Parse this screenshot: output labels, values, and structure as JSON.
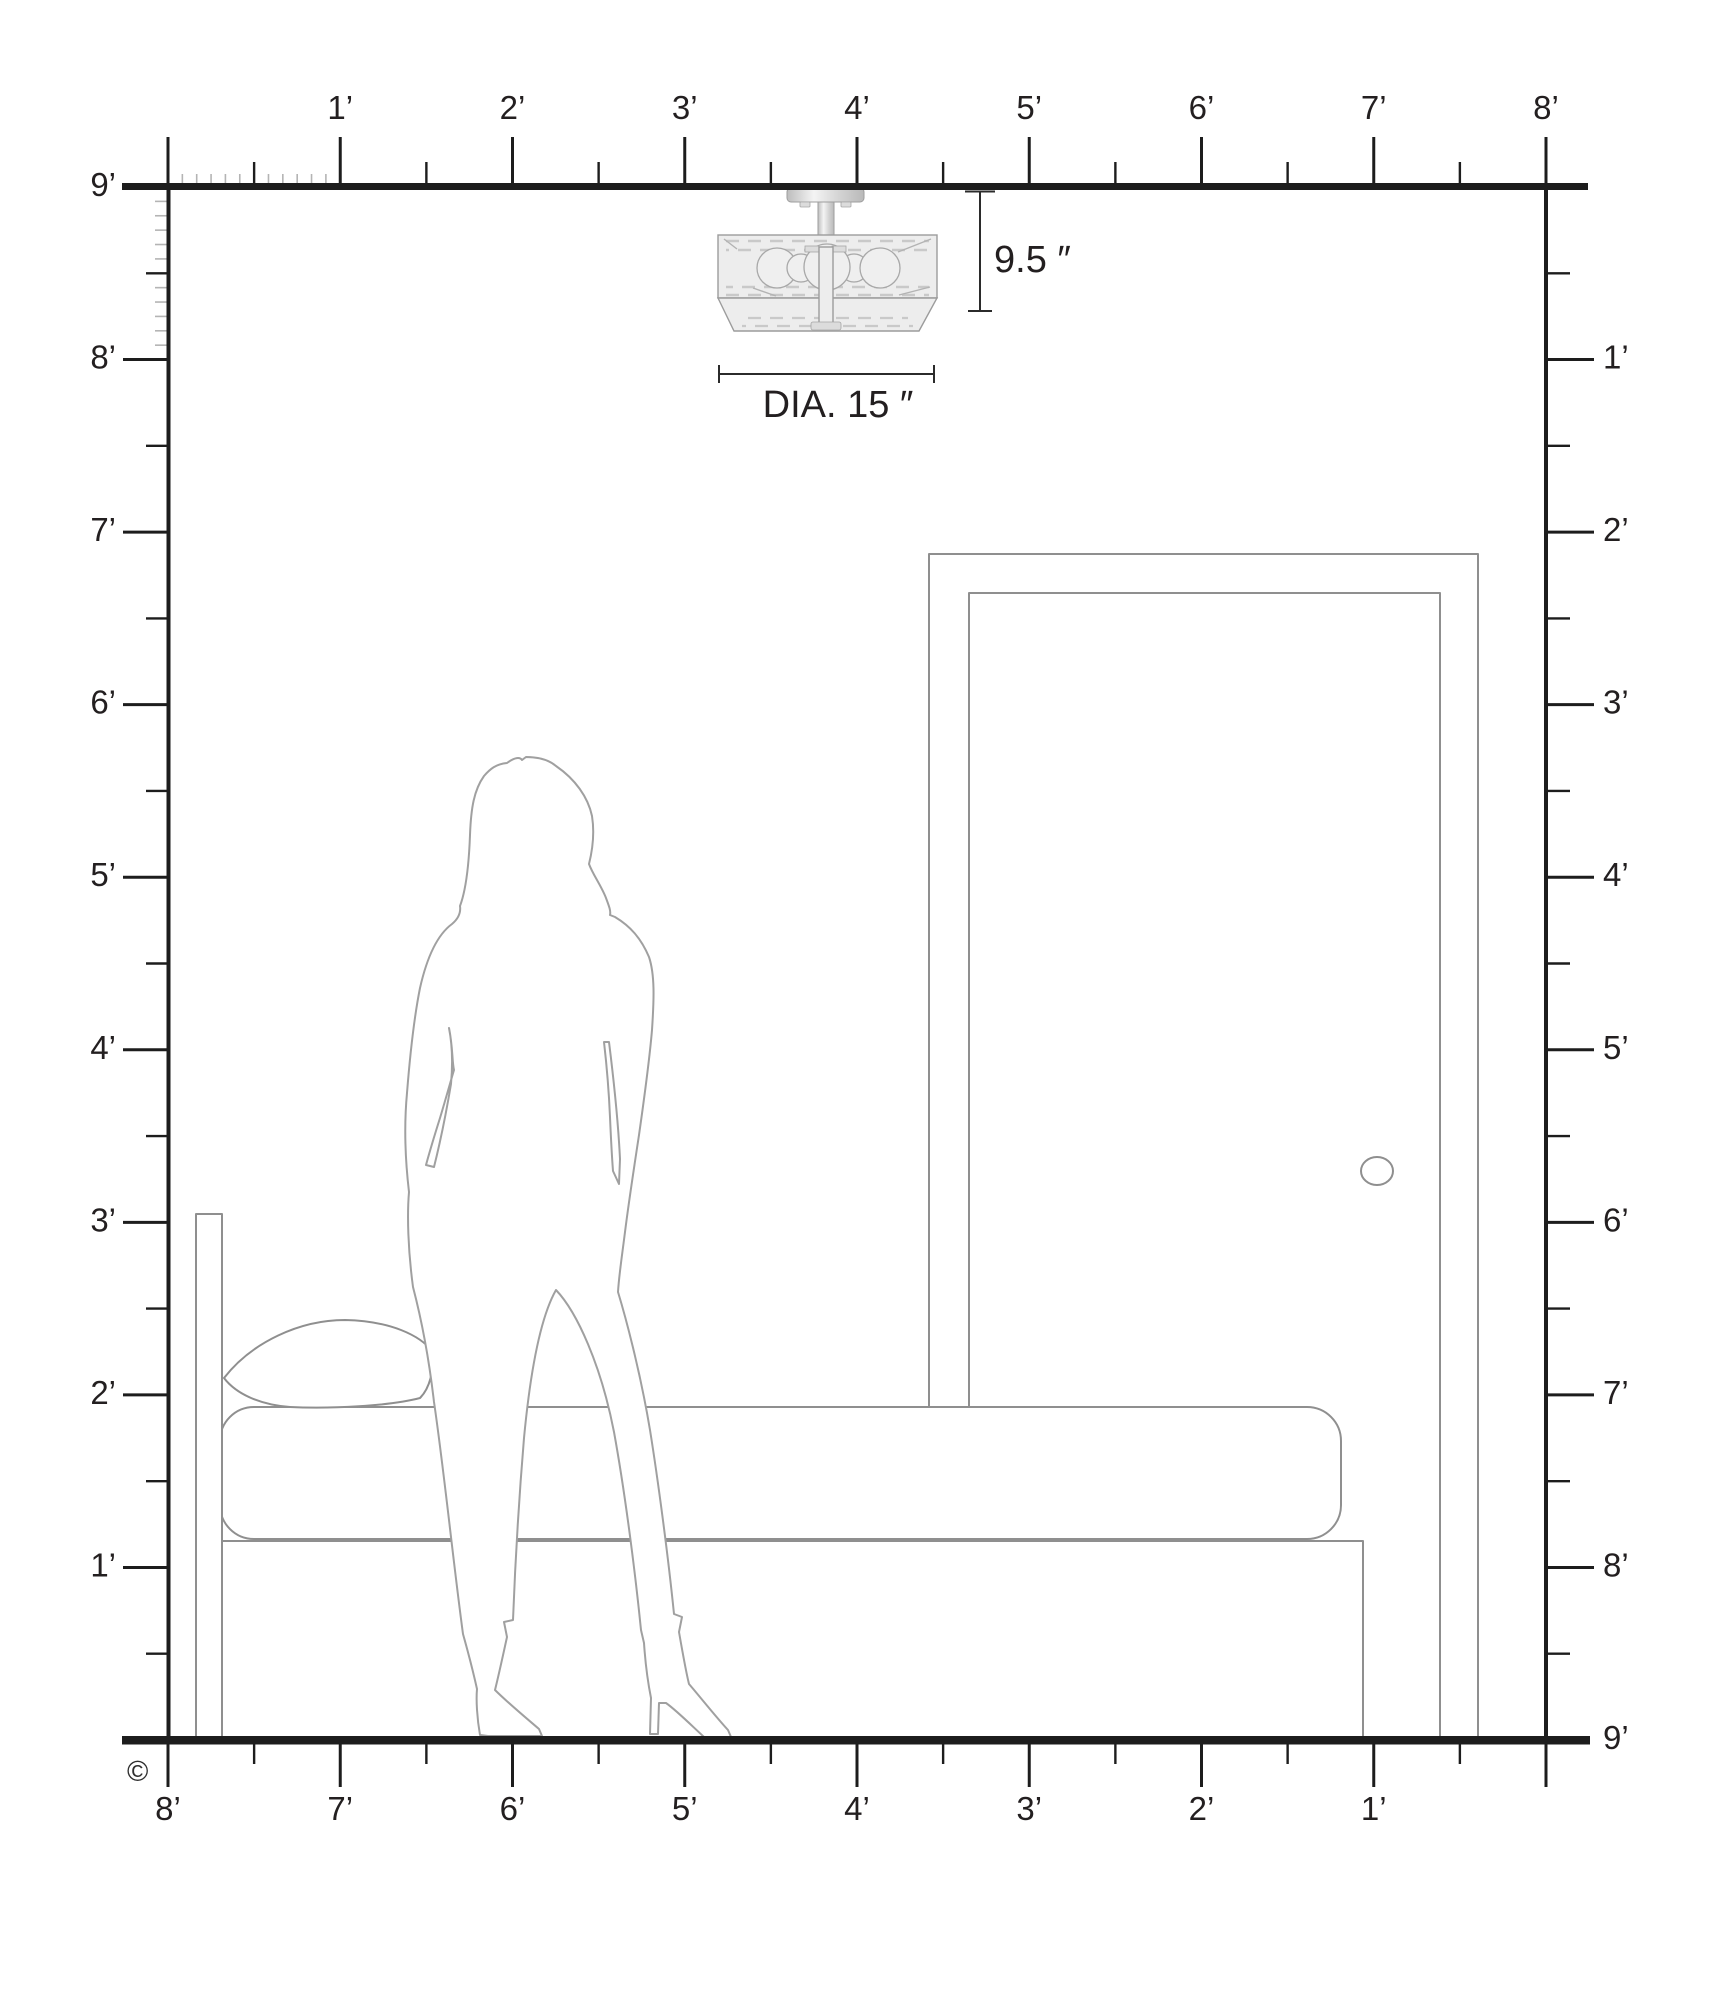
{
  "rulers": {
    "top": {
      "unit": "feet",
      "labels": [
        "1’",
        "2’",
        "3’",
        "4’",
        "5’",
        "6’",
        "7’",
        "8’"
      ]
    },
    "left": {
      "unit": "feet",
      "labels": [
        "9’",
        "8’",
        "7’",
        "6’",
        "5’",
        "4’",
        "3’",
        "2’",
        "1’"
      ]
    },
    "right": {
      "unit": "feet",
      "labels": [
        "1’",
        "2’",
        "3’",
        "4’",
        "5’",
        "6’",
        "7’",
        "8’",
        "9’"
      ]
    },
    "bottom": {
      "unit": "feet",
      "labels": [
        "8’",
        "7’",
        "6’",
        "5’",
        "4’",
        "3’",
        "2’",
        "1’"
      ]
    }
  },
  "annotations": {
    "fixture_height": "9.5 ″",
    "fixture_diameter": "DIA. 15 ″",
    "copyright": "©"
  },
  "scene": {
    "room_height_feet": 9,
    "room_width_feet": 8,
    "objects": [
      "semi-flush-ceiling-light",
      "door",
      "single-bed",
      "pillow",
      "woman-silhouette"
    ]
  },
  "colors": {
    "ruler_dark": "#1d1d1d",
    "minor_tick": "#b4b4b4",
    "label_text": "#231f20",
    "outline": "#8f8f8f",
    "fixture_outline": "#9c9c9c",
    "fixture_fill": "#ededed",
    "fixture_dash": "#c9c9c9",
    "background": "#ffffff"
  }
}
